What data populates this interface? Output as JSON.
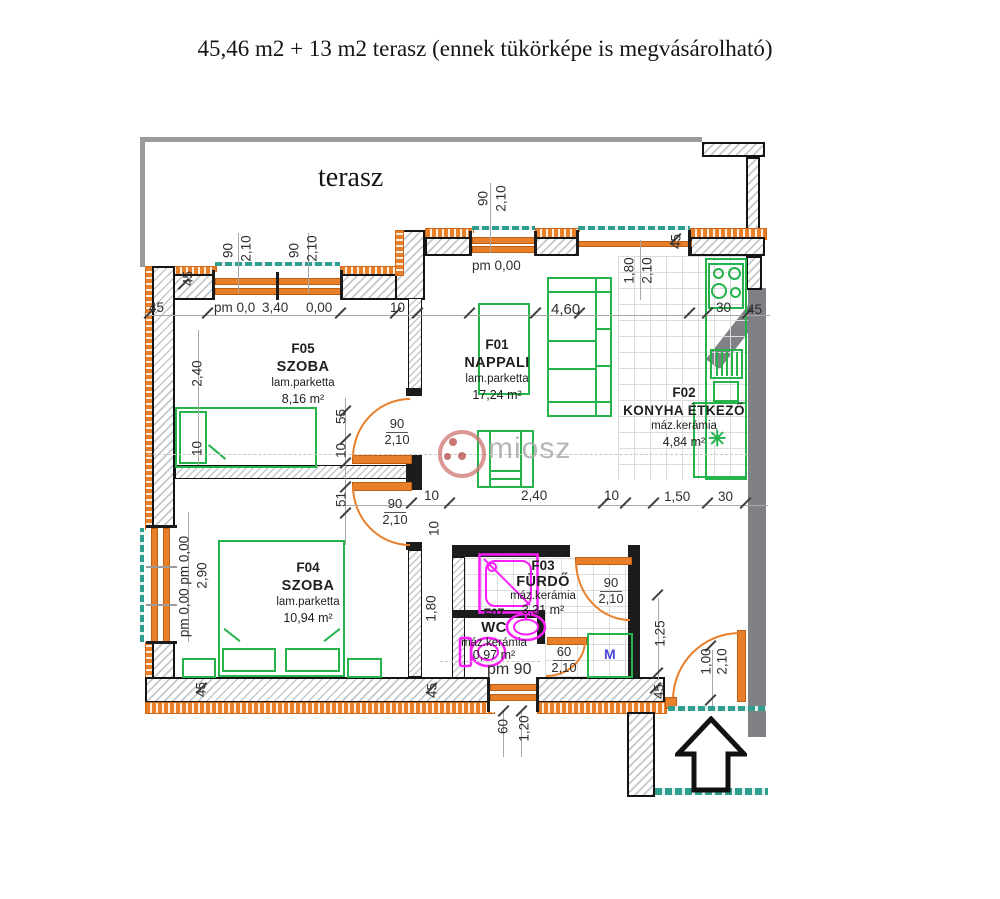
{
  "title": "45,46 m2 + 13 m2 terasz (ennek tükörképe is megvásárolható)",
  "plan": {
    "terrace_label": "terasz",
    "watermark_text": "miosz",
    "appliance_label": "M",
    "symbols": {
      "asterisk": "✳"
    },
    "rooms": {
      "f05": {
        "id": "F05",
        "name": "SZOBA",
        "floor": "lam.parketta",
        "area": "8,16 m²"
      },
      "f01": {
        "id": "F01",
        "name": "NAPPALI",
        "floor": "lam.parketta",
        "area": "17,24 m²"
      },
      "f02": {
        "id": "F02",
        "name": "KONYHA ÉTKEZŐ",
        "floor": "máz.kerámia",
        "area": "4,84 m²"
      },
      "f04": {
        "id": "F04",
        "name": "SZOBA",
        "floor": "lam.parketta",
        "area": "10,94 m²"
      },
      "f03": {
        "id": "F03",
        "name": "FÜRDŐ",
        "floor": "máz.kerámia",
        "area": "3,31 m²"
      },
      "f07": {
        "id": "F07",
        "name": "WC",
        "floor": "máz.kerámia",
        "area": "0,97 m²"
      }
    },
    "dims": {
      "d45": "45",
      "d90": "90",
      "d210": "2,10",
      "d10": "10",
      "d30": "30",
      "d55": "55",
      "d51": "51",
      "d60": "60",
      "d100": "1,00",
      "d120": "1,20",
      "d125": "1,25",
      "d150": "1,50",
      "d180": "1,80",
      "d240": "2,40",
      "d290": "2,90",
      "d340": "3,40",
      "d460": "4,60",
      "d000": "0,00",
      "pm00": "pm 0,00",
      "pm0": "pm 0,0",
      "pm90": "pm 90",
      "pmcol": "pm 0,00 pm 0,00"
    },
    "colors": {
      "wall_orange": "#e87f2a",
      "furniture_green": "#25b34b",
      "fixture_magenta": "#fb1efb",
      "window_teal": "#2f9e8f",
      "neighbor_gray": "#7f8184"
    }
  }
}
